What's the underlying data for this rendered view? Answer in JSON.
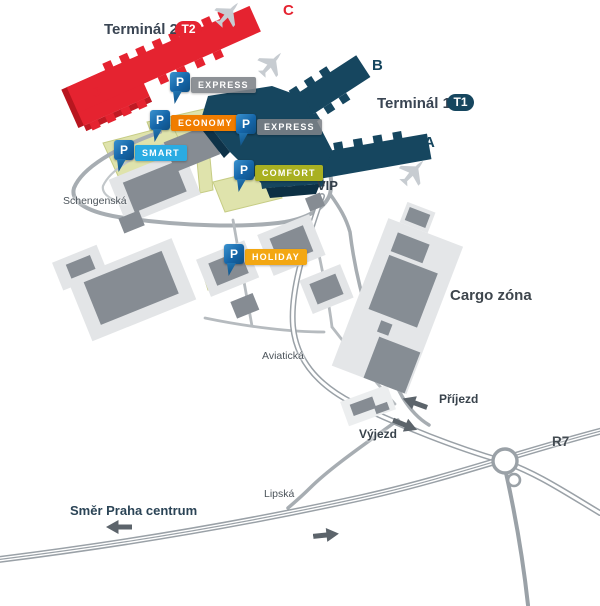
{
  "pin_letter": "P",
  "terminals": {
    "t2": {
      "label": "Terminál 2",
      "badge": "T2",
      "pier_c": "C",
      "pier_d": "D",
      "color": "#e52330"
    },
    "t1": {
      "label": "Terminál 1",
      "badge": "T1",
      "pier_a": "A",
      "pier_b": "B",
      "color": "#16465f"
    }
  },
  "parking": [
    {
      "id": "express-t2",
      "label": "EXPRESS",
      "color": "rgba(125,130,136,0.88)"
    },
    {
      "id": "express-t1",
      "label": "EXPRESS",
      "color": "rgba(125,130,136,0.88)"
    },
    {
      "id": "economy",
      "label": "ECONOMY",
      "color": "#f07d00"
    },
    {
      "id": "smart",
      "label": "SMART",
      "color": "#2aabe2"
    },
    {
      "id": "comfort",
      "label": "COMFORT",
      "color": "#a9b021"
    },
    {
      "id": "holiday",
      "label": "HOLIDAY",
      "color": "#f3a712"
    }
  ],
  "zones": {
    "vip": "VIP",
    "cargo": "Cargo zóna"
  },
  "streets": {
    "schengenska": "Schengenská",
    "aviaticka": "Aviatická",
    "lipska": "Lipská",
    "r7": "R7"
  },
  "directions": {
    "prijezd": "Příjezd",
    "vyjezd": "Výjezd",
    "praha": "Směr Praha centrum"
  }
}
